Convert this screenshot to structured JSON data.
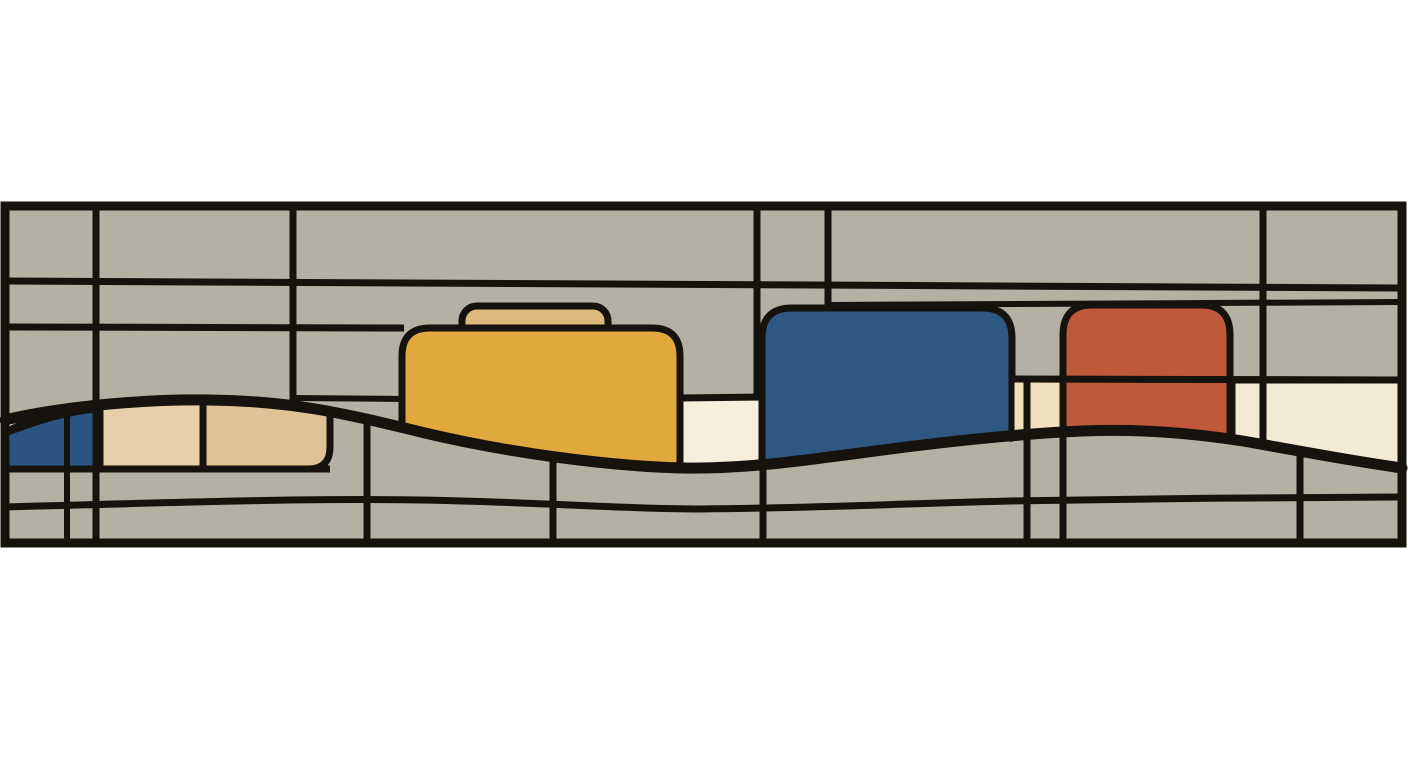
{
  "artwork": {
    "style": "abstract-stained-glass-frieze",
    "orientation": "horizontal-band",
    "shapes": [
      {
        "name": "frieze-band-background",
        "fill": "panel_gray"
      },
      {
        "name": "yellow-block",
        "fill": "yellow"
      },
      {
        "name": "yellow-block-tab",
        "fill": "tan_tab"
      },
      {
        "name": "blue-block",
        "fill": "blue"
      },
      {
        "name": "red-block",
        "fill": "red"
      },
      {
        "name": "left-blue-wedge",
        "fill": "blue_left"
      },
      {
        "name": "left-cream-wedge",
        "fill": "cream"
      },
      {
        "name": "tan-cell-left",
        "fill": "tan_light"
      },
      {
        "name": "tan-cell-right",
        "fill": "tan_dark"
      },
      {
        "name": "cream-cell-middle",
        "fill": "cream_bright"
      },
      {
        "name": "cream-sliver-left",
        "fill": "cream_warm"
      },
      {
        "name": "cream-sliver-right",
        "fill": "cream_warm"
      },
      {
        "name": "cream-panel-right",
        "fill": "cream"
      },
      {
        "name": "wave-line",
        "stroke": "line_black"
      },
      {
        "name": "grid-lines",
        "stroke": "line_black"
      }
    ]
  },
  "palette": {
    "background": "#ffffff",
    "panel_gray": "#b4b0a4",
    "line_black": "#16130e",
    "yellow": "#e1a83e",
    "tan_tab": "#ddba7c",
    "tan_light": "#e7d0a8",
    "tan_dark": "#dfc295",
    "blue": "#2e5781",
    "blue_left": "#2b5480",
    "red": "#c0583c",
    "cream": "#f3ead6",
    "cream_bright": "#f6efdc",
    "cream_warm": "#f0dfbc"
  }
}
